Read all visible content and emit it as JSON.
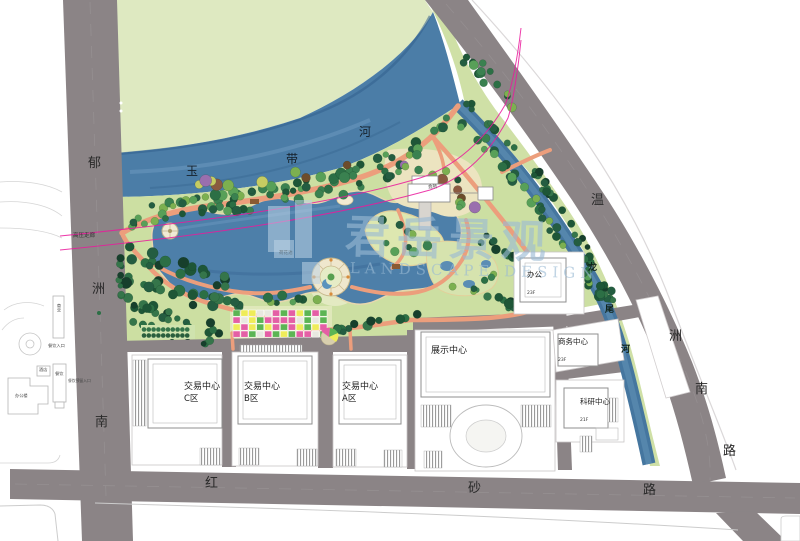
{
  "watermark": {
    "cn": "君岳景观",
    "en": "LANDSCAPE DESIGN"
  },
  "roads": {
    "west": {
      "name": "郁洲南",
      "chars": [
        "郁",
        "洲",
        "南"
      ]
    },
    "east": {
      "name": "温洲南路",
      "chars": [
        "温",
        "洲",
        "南",
        "路"
      ]
    },
    "south": {
      "name": "红砂路",
      "chars": [
        "红",
        "砂",
        "路"
      ]
    }
  },
  "rivers": {
    "north": {
      "name": "玉带河",
      "chars": [
        "玉",
        "带",
        "河"
      ]
    },
    "east": {
      "name": "龙尾河",
      "chars": [
        "龙",
        "尾",
        "河"
      ]
    }
  },
  "annotations": {
    "hv_corridor": "高压走廊",
    "clubhouse": "会所",
    "lotus_pond": "荷花池"
  },
  "buildings": {
    "trade_c": {
      "name": "交易中心",
      "zone": "C区"
    },
    "trade_b": {
      "name": "交易中心",
      "zone": "B区"
    },
    "trade_a": {
      "name": "交易中心",
      "zone": "A区"
    },
    "exhibition": {
      "name": "展示中心"
    },
    "office": {
      "name": "办公",
      "floors": "23F"
    },
    "business": {
      "name": "商务中心",
      "floors": "23F"
    },
    "research": {
      "name": "科研中心",
      "floors": "21F"
    }
  },
  "west_district": {
    "commercial": "商业",
    "hotel": "酒店",
    "dining": "餐饮",
    "office_building": "办公楼",
    "dining_entrance": "餐饮入口",
    "reserved_entrance": "餐饮预留入口"
  },
  "colors": {
    "road": "#8b8486",
    "field": "#dee9c1",
    "water": "#4b7da7",
    "water_light": "#6f9cc2",
    "park": "#ccdfa2",
    "path": "#ec9e7c",
    "tree_palette": [
      "#2c6f45",
      "#3a8150",
      "#58a058",
      "#245d41",
      "#7cb050",
      "#1e5637"
    ],
    "tree_dark": [
      "#1e5637",
      "#245d41",
      "#2c6f45",
      "#173f2c",
      "#35754a"
    ],
    "tree_accent": [
      "#6d4c2b",
      "#8a5a40",
      "#c6cc62",
      "#7cb050",
      "#9a6fae"
    ],
    "flower_palette": [
      "#e45fa5",
      "#5cb554",
      "#efec59"
    ],
    "hv_line": "#ea1a9c",
    "watermark": "rgba(154,186,211,0.62)"
  }
}
